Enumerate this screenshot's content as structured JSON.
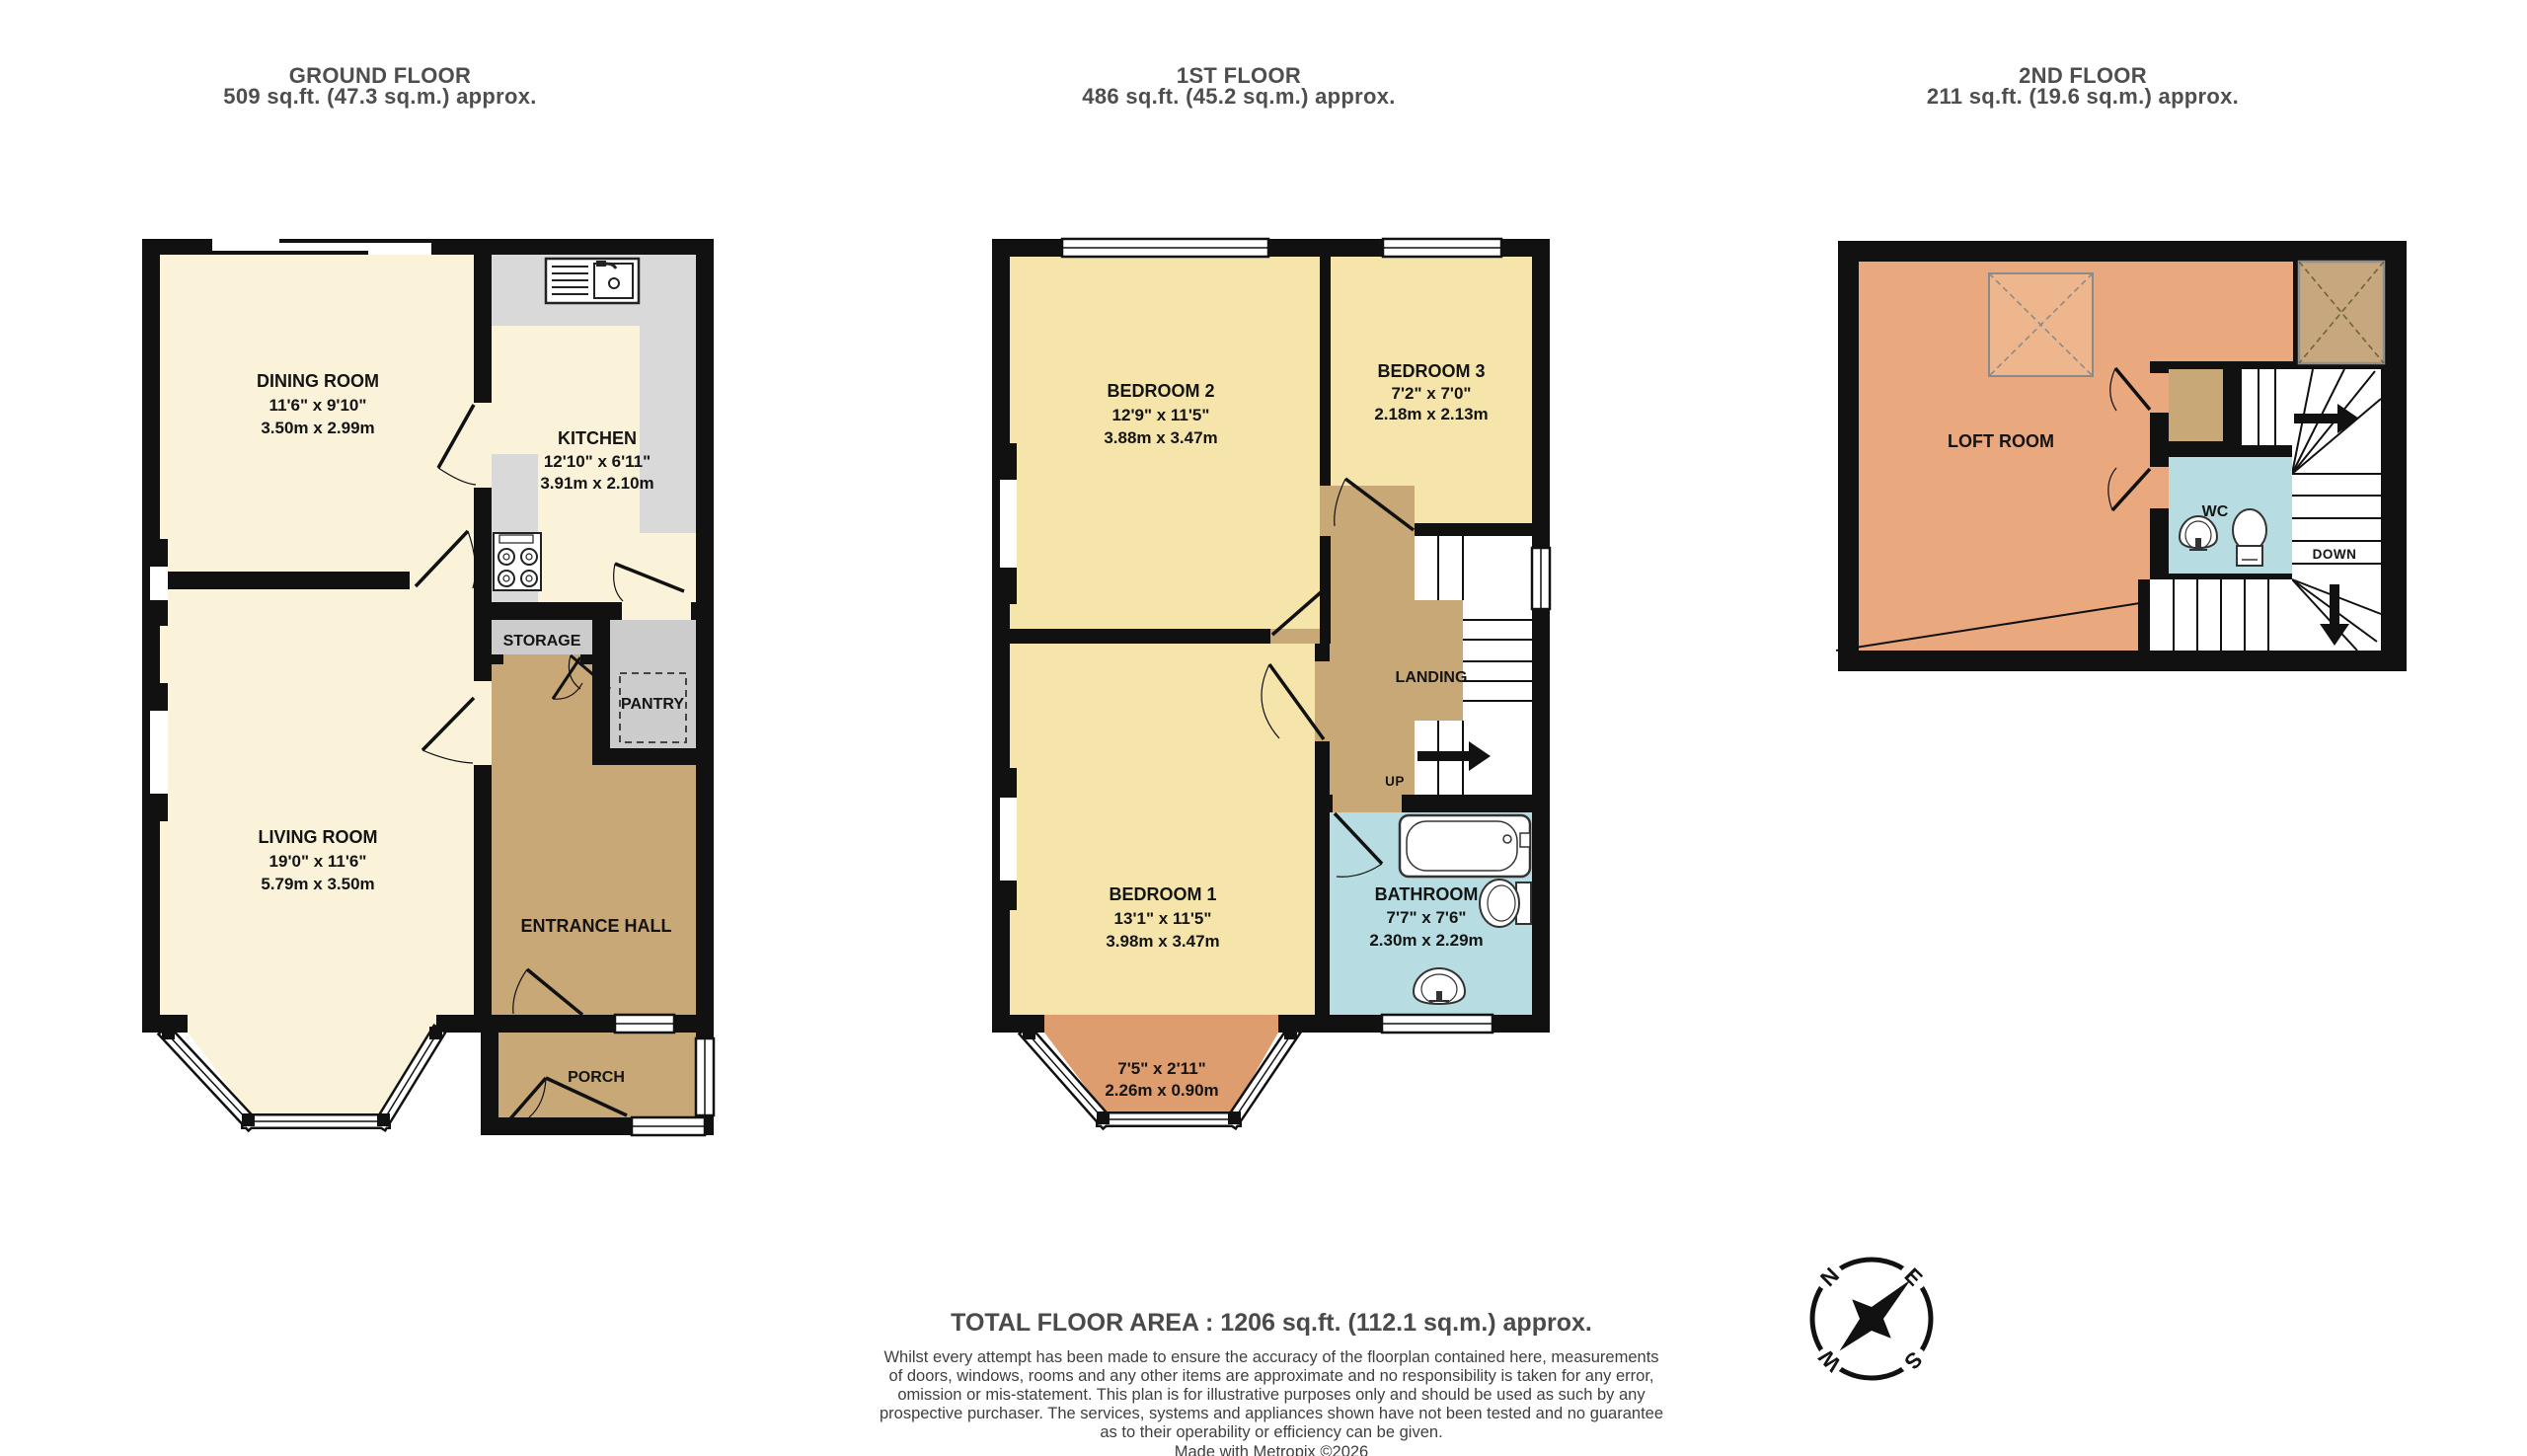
{
  "floors": [
    {
      "title": "GROUND FLOOR",
      "area": "509 sq.ft. (47.3 sq.m.) approx.",
      "rooms": {
        "dining": {
          "name": "DINING ROOM",
          "dims_ft": "11'6\"  x 9'10\"",
          "dims_m": "3.50m  x 2.99m"
        },
        "kitchen": {
          "name": "KITCHEN",
          "dims_ft": "12'10\"  x 6'11\"",
          "dims_m": "3.91m  x 2.10m"
        },
        "living": {
          "name": "LIVING ROOM",
          "dims_ft": "19'0\"  x 11'6\"",
          "dims_m": "5.79m  x 3.50m"
        },
        "storage": {
          "name": "STORAGE"
        },
        "pantry": {
          "name": "PANTRY"
        },
        "hall": {
          "name": "ENTRANCE HALL"
        },
        "porch": {
          "name": "PORCH"
        }
      }
    },
    {
      "title": "1ST FLOOR",
      "area": "486 sq.ft. (45.2 sq.m.) approx.",
      "rooms": {
        "bedroom2": {
          "name": "BEDROOM 2",
          "dims_ft": "12'9\"  x 11'5\"",
          "dims_m": "3.88m  x 3.47m"
        },
        "bedroom3": {
          "name": "BEDROOM 3",
          "dims_ft": "7'2\"  x 7'0\"",
          "dims_m": "2.18m  x 2.13m"
        },
        "bedroom1": {
          "name": "BEDROOM 1",
          "dims_ft": "13'1\"  x 11'5\"",
          "dims_m": "3.98m  x 3.47m"
        },
        "bathroom": {
          "name": "BATHROOM",
          "dims_ft": "7'7\"  x 7'6\"",
          "dims_m": "2.30m  x 2.29m"
        },
        "landing": {
          "name": "LANDING"
        },
        "bay": {
          "dims_ft": "7'5\"  x 2'11\"",
          "dims_m": "2.26m  x 0.90m"
        }
      },
      "up_label": "UP"
    },
    {
      "title": "2ND FLOOR",
      "area": "211 sq.ft. (19.6 sq.m.) approx.",
      "rooms": {
        "loft": {
          "name": "LOFT ROOM"
        },
        "wc": {
          "name": "WC"
        }
      },
      "down_label": "DOWN"
    }
  ],
  "footer": {
    "total": "TOTAL FLOOR AREA : 1206 sq.ft. (112.1 sq.m.) approx.",
    "lines": [
      "Whilst every attempt has been made to ensure the accuracy of the floorplan contained here, measurements",
      "of doors, windows, rooms and any other items are approximate and no responsibility is taken for any error,",
      "omission or mis-statement. This plan is for illustrative purposes only and should be used as such by any",
      "prospective purchaser. The services, systems and appliances shown have not been tested and no guarantee",
      "as to their operability or efficiency can be given."
    ],
    "made_with": "Made with Metropix ©2026"
  },
  "compass": {
    "n": "N",
    "e": "E",
    "s": "S",
    "w": "W"
  },
  "colors": {
    "wall": "#111111",
    "cream": "#faf3d9",
    "bedroom_yellow": "#f6e5ab",
    "hall_tan": "#c9a877",
    "bath_blue": "#b7dce2",
    "loft_salmon": "#e9a87e",
    "bay_orange": "#dd9d6f",
    "counter_gray": "#d9d9d9",
    "pantry_gray": "#cccccc",
    "label_text": "#141414",
    "header_text": "#4e4e4e"
  }
}
